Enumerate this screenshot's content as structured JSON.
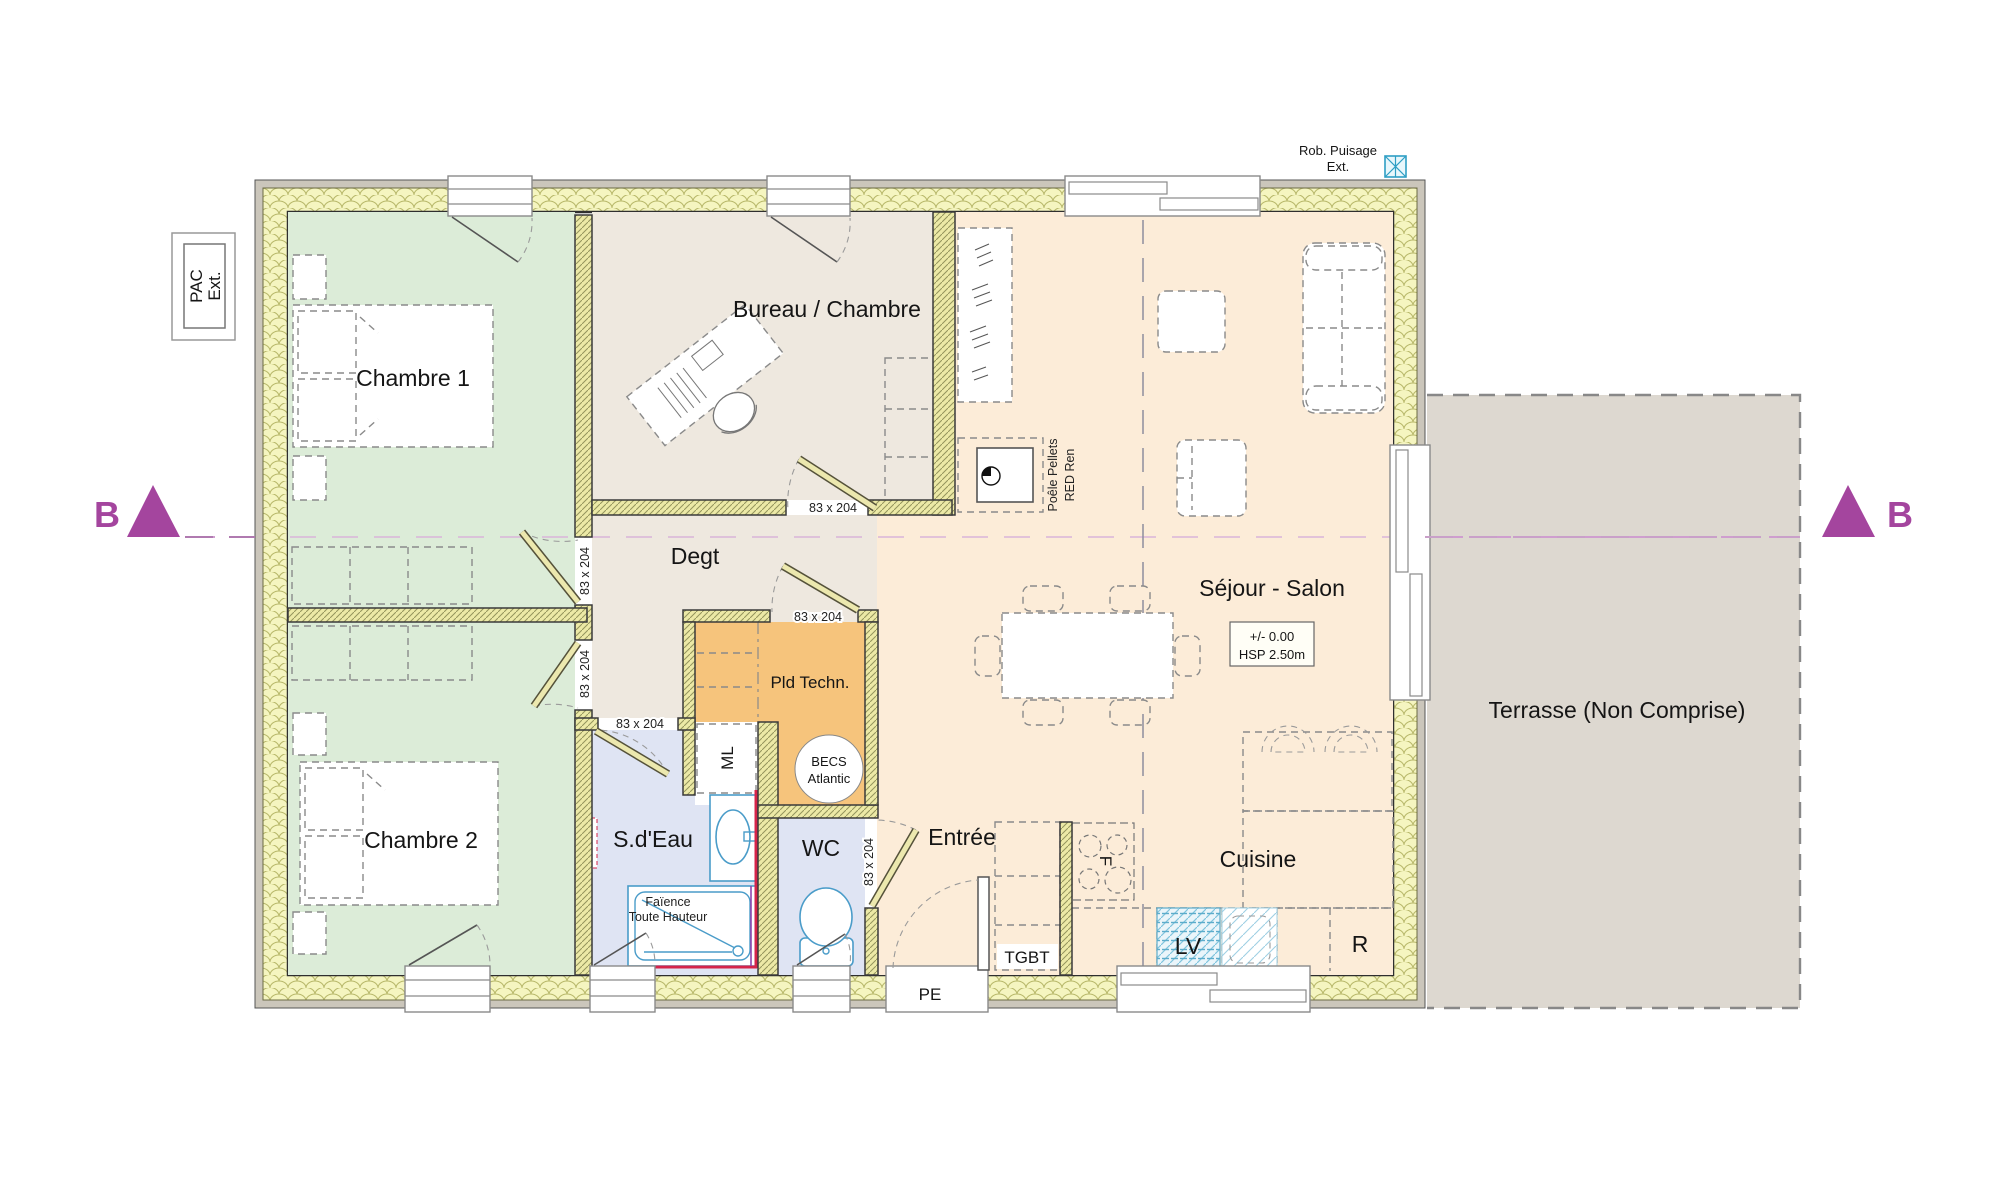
{
  "plan": {
    "rooms": {
      "chambre1": "Chambre 1",
      "chambre2": "Chambre 2",
      "bureau": "Bureau / Chambre",
      "degt": "Degt",
      "sejour": "Séjour - Salon",
      "cuisine": "Cuisine",
      "entree": "Entrée",
      "sdeau": "S.d'Eau",
      "wc": "WC",
      "pld_techn": "Pld Techn.",
      "terrasse": "Terrasse (Non Comprise)"
    },
    "labels": {
      "door_size": "83 x 204",
      "pe": "PE",
      "tgbt": "TGBT",
      "ml": "ML",
      "lv": "LV",
      "fridge": "R",
      "oven": "F",
      "becs": [
        "BECS",
        "Atlantic"
      ],
      "poele": [
        "Poêle Pellets",
        "RED Ren"
      ],
      "faience": [
        "Faïence",
        "Toute Hauteur"
      ],
      "level": [
        "+/- 0.00",
        "HSP 2.50m"
      ],
      "pac": [
        "PAC",
        "Ext."
      ],
      "rob_puisage": [
        "Rob. Puisage",
        "Ext."
      ],
      "section_marker": "B"
    },
    "colors": {
      "bedroom": "#dcecd8",
      "office_hall": "#eee8df",
      "living": "#fcecd8",
      "tech": "#f6c47c",
      "wet": "#dfe4f3",
      "terrace": "#ddd8d0",
      "wall_insulation": "#f5f5c0",
      "section_purple": "#a4459e",
      "accent_orange": "#e87d1e",
      "accent_red": "#d5244a",
      "fixture_blue": "#4a9cc9"
    }
  }
}
